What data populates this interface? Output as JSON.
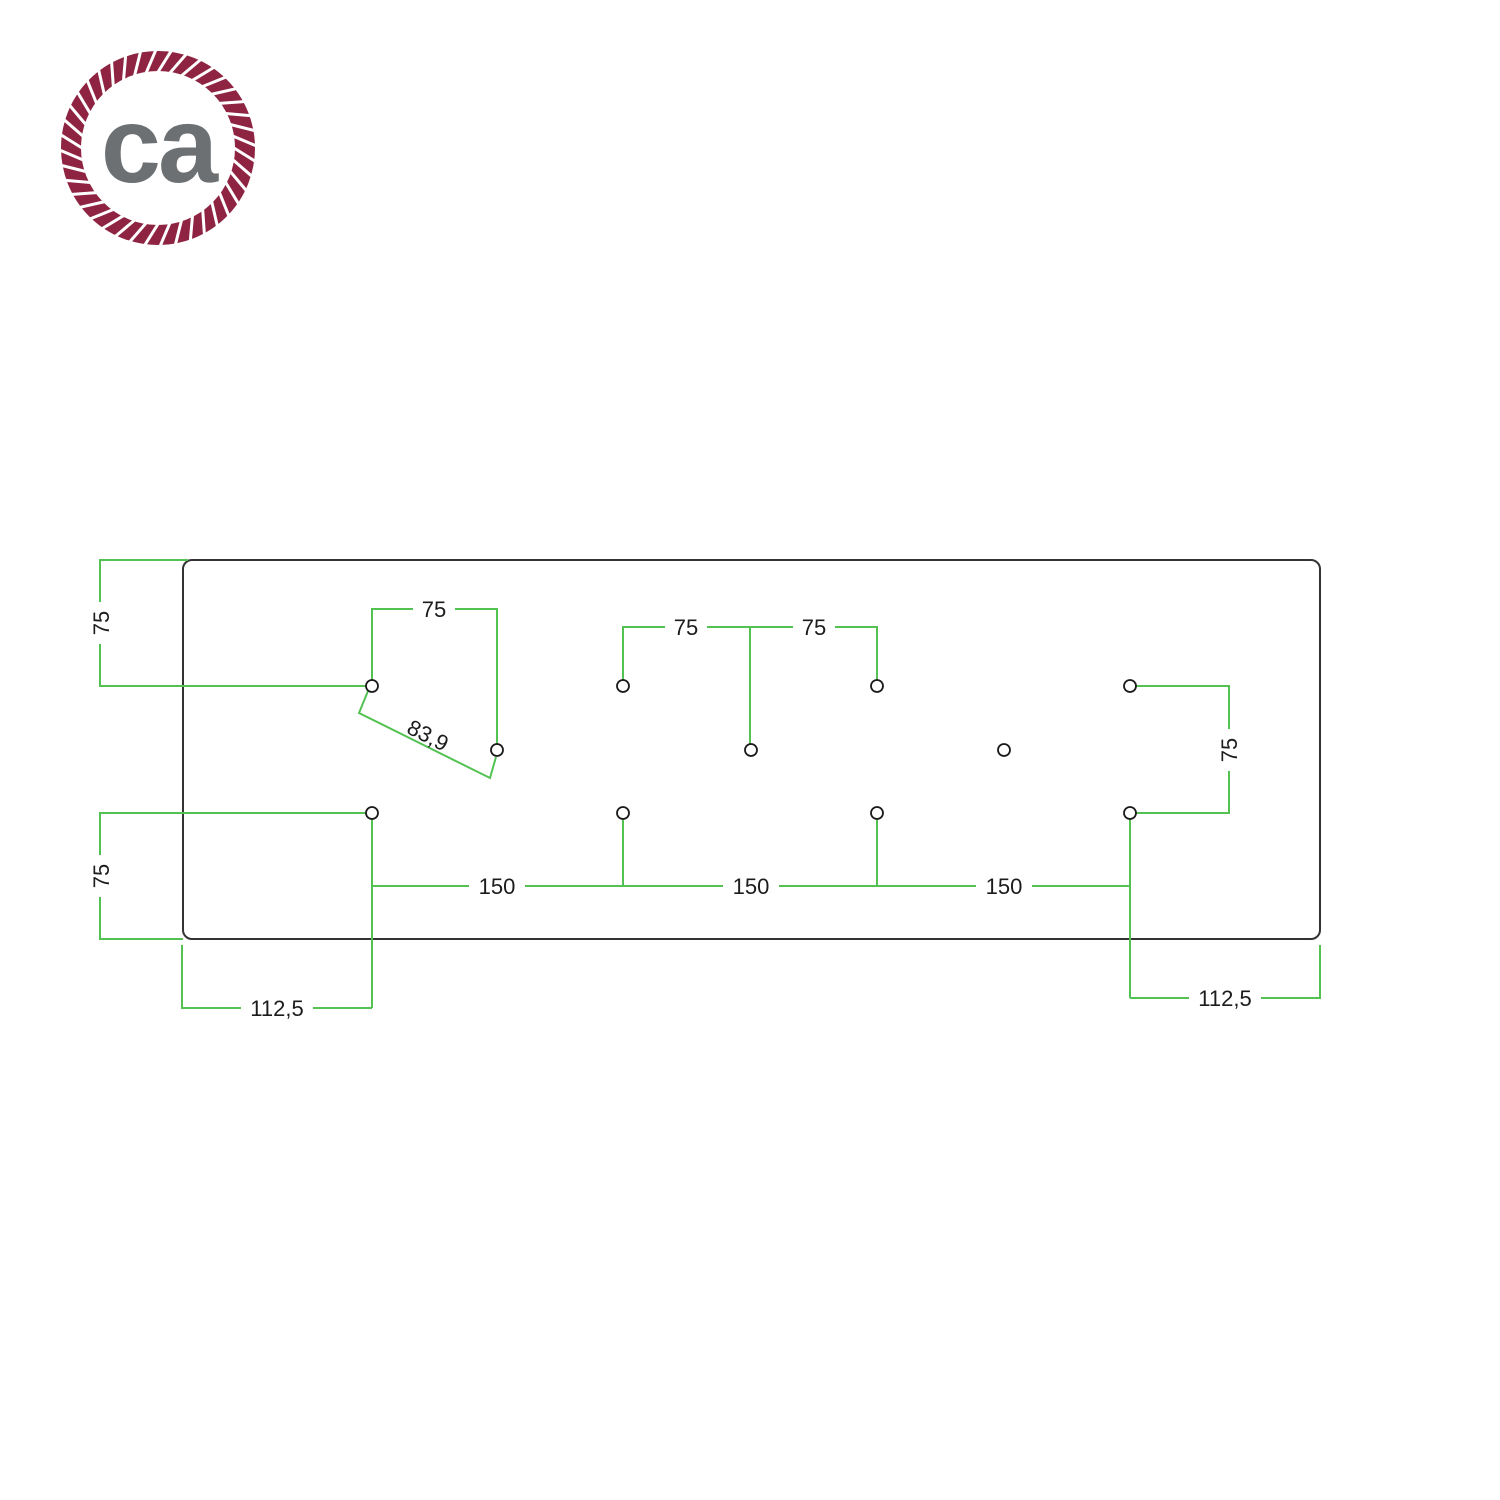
{
  "logo": {
    "text": "ca",
    "rope_color": "#8e2342",
    "text_color": "#6d7072"
  },
  "drawing": {
    "outline_color": "#333333",
    "dimension_color": "#53c253",
    "hole_count": 11,
    "dimension_labels": {
      "top_left_vertical": "75",
      "top_span": "75",
      "diagonal": "83,9",
      "center_span_left": "75",
      "center_span_right": "75",
      "right_vertical": "75",
      "bottom_left_vertical": "75",
      "bottom_span_1": "150",
      "bottom_span_2": "150",
      "bottom_span_3": "150",
      "bottom_offset_left": "112,5",
      "bottom_offset_right": "112,5"
    }
  }
}
